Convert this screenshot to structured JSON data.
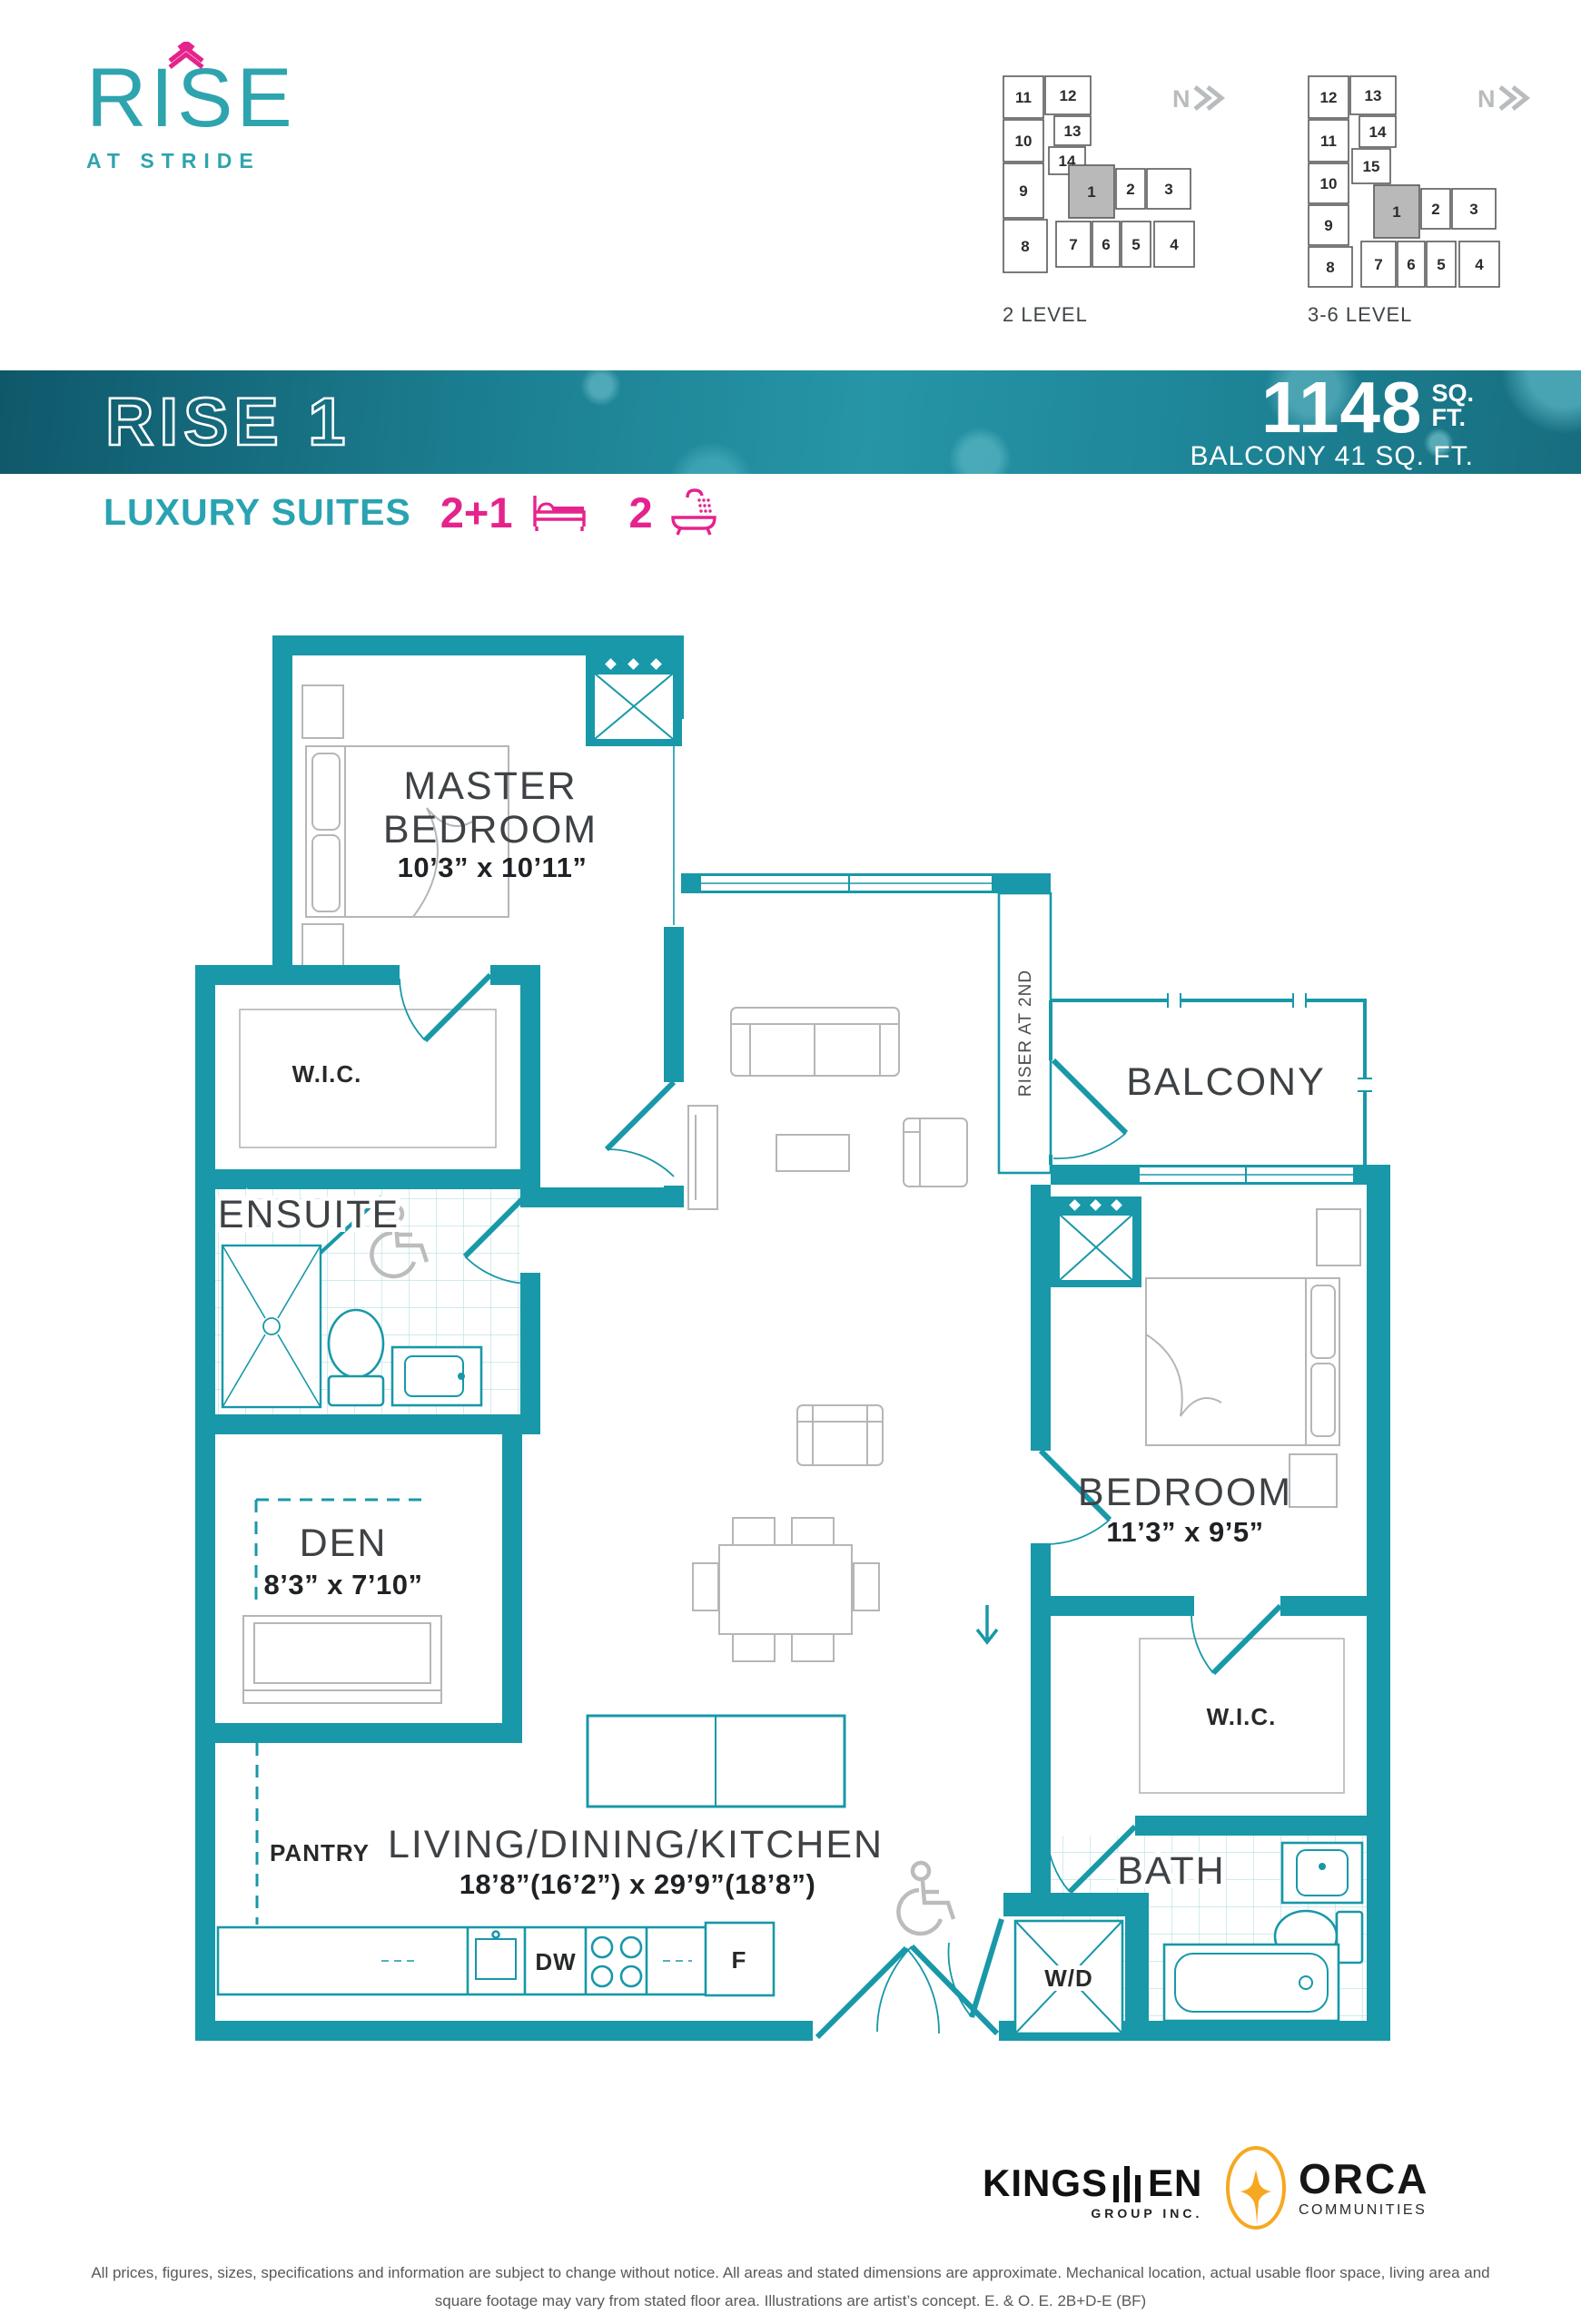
{
  "brand": {
    "logo_text": "RISE",
    "logo_sub": "AT STRIDE"
  },
  "keyplans": {
    "compass": "N",
    "level2": {
      "label": "2 LEVEL",
      "highlighted": "1",
      "units": [
        "11",
        "12",
        "10",
        "13",
        "14",
        "9",
        "1",
        "2",
        "3",
        "8",
        "7",
        "6",
        "5",
        "4"
      ]
    },
    "level36": {
      "label": "3-6 LEVEL",
      "highlighted": "1",
      "units": [
        "12",
        "13",
        "11",
        "14",
        "10",
        "15",
        "9",
        "1",
        "2",
        "3",
        "8",
        "7",
        "6",
        "5",
        "4"
      ]
    }
  },
  "banner": {
    "plan_name": "RISE 1",
    "area": "1148",
    "unit1": "SQ.",
    "unit2": "FT.",
    "balcony": "BALCONY 41 SQ. FT."
  },
  "suite": {
    "type": "LUXURY SUITES",
    "beds": "2+1",
    "baths": "2"
  },
  "floorplan": {
    "rooms": {
      "master": {
        "line1": "MASTER",
        "line2": "BEDROOM",
        "dim": "10’3” x 10’11”"
      },
      "wic1": "W.I.C.",
      "ensuite": "ENSUITE",
      "den": {
        "name": "DEN",
        "dim": "8’3” x 7’10”"
      },
      "pantry": "PANTRY",
      "living": {
        "name": "LIVING/DINING/KITCHEN",
        "dim": "18’8”(16’2”) x 29’9”(18’8”)"
      },
      "balcony": "BALCONY",
      "bedroom": {
        "name": "BEDROOM",
        "dim": "11’3” x 9’5”"
      },
      "wic2": "W.I.C.",
      "bath": "BATH"
    },
    "labels": {
      "riser": "RISER AT 2ND",
      "dw": "DW",
      "fridge": "F",
      "wd": "W/D"
    }
  },
  "footer": {
    "kingsmen": {
      "part1": "KINGS",
      "part2": "EN",
      "sub": "GROUP INC."
    },
    "orca": {
      "name": "ORCA",
      "sub": "COMMUNITIES"
    },
    "disclaimer1": "All prices, figures, sizes, specifications and information are subject to change without notice. All areas and stated dimensions are approximate. Mechanical location, actual usable floor space, living area and",
    "disclaimer2": "square footage may vary from stated floor area. Illustrations are artist’s concept. E. & O. E. 2B+D-E (BF)"
  },
  "colors": {
    "teal": "#1898A8",
    "logoTeal": "#2EA4AF",
    "pink": "#E5238C",
    "furniture": "#b4b6b8",
    "keyGray": "#b9b9b9",
    "orange": "#F6A821"
  }
}
